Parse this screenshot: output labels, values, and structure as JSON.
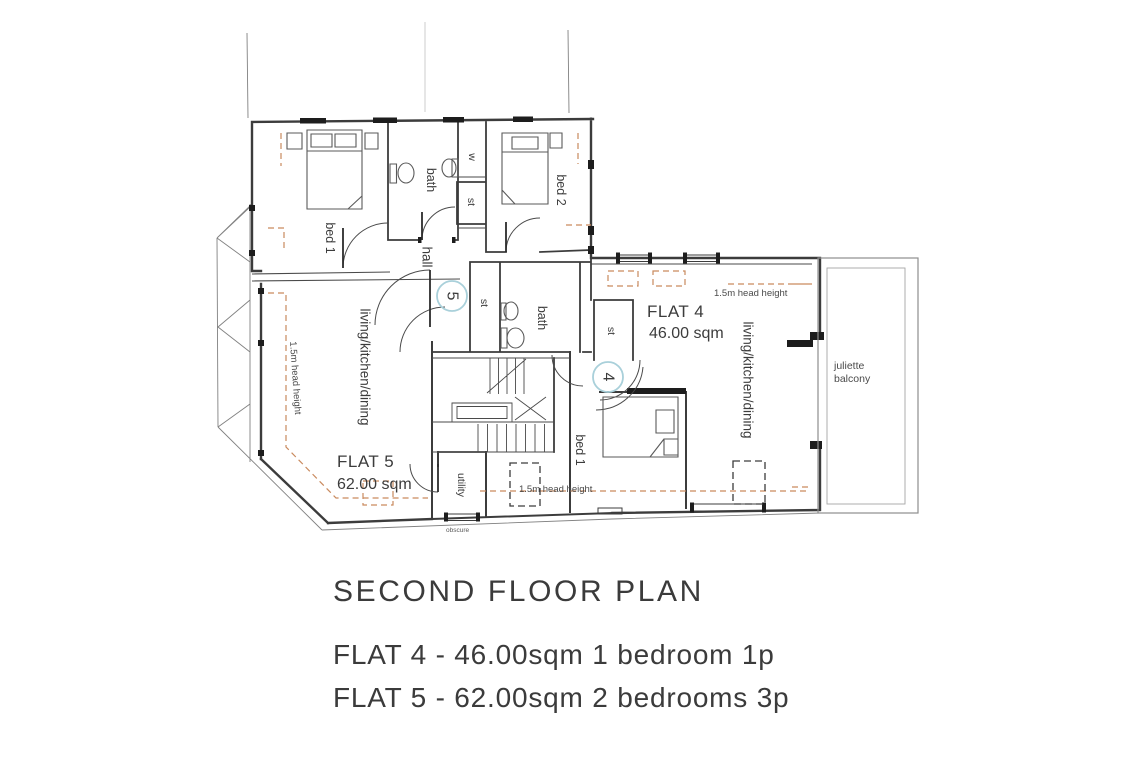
{
  "colors": {
    "wall": "#3c3c3c",
    "light_line": "#8e8e8e",
    "dashed_annotation": "#c98a5e",
    "marker_ring": "#a9d0da",
    "text": "#3b3b3b",
    "background": "#ffffff"
  },
  "flat5": {
    "marker": "5",
    "name": "FLAT 5",
    "area": "62.00 sqm",
    "rooms": {
      "bed1": "bed 1",
      "bath": "bath",
      "wardrobe": "w",
      "store_top": "st",
      "bed2": "bed 2",
      "hall": "hall",
      "store": "st",
      "living": "living/kitchen/dining",
      "utility": "utility"
    }
  },
  "flat4": {
    "marker": "4",
    "name": "FLAT 4",
    "area": "46.00 sqm",
    "rooms": {
      "store": "st",
      "bath": "bath",
      "bed1": "bed 1",
      "living": "living/kitchen/dining"
    }
  },
  "annotations": {
    "head_height": "1.5m head height",
    "balcony_line1": "juliette",
    "balcony_line2": "balcony",
    "obscure": "obscure"
  },
  "legend": {
    "title": "SECOND FLOOR PLAN",
    "flat4_line": "FLAT 4 - 46.00sqm 1 bedroom 1p",
    "flat5_line": "FLAT 5 - 62.00sqm 2 bedrooms 3p"
  }
}
